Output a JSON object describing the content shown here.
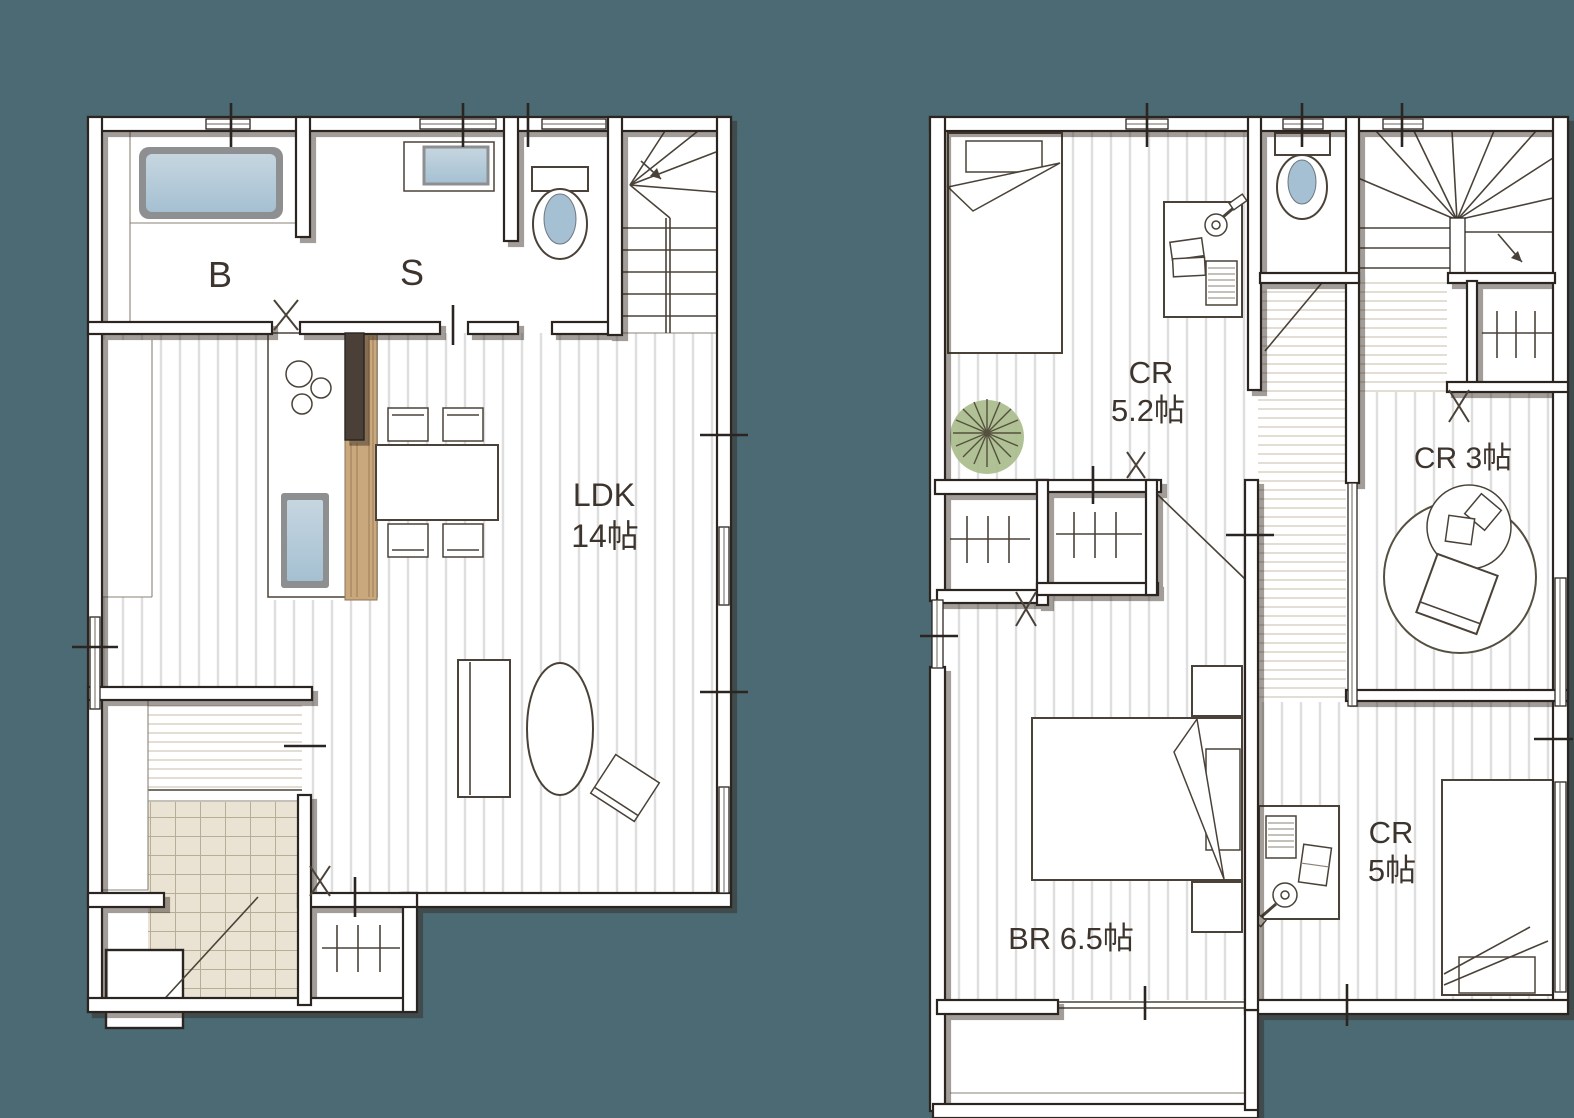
{
  "colors": {
    "background": "#4c6a73",
    "ink": "#2b2522",
    "text": "#3d352d",
    "water_light": "#c6d6e0",
    "water": "#a5c0d2",
    "fixture_rim": "#8d8f91",
    "wood": "#c9a87d",
    "wood_line": "#a5835c",
    "tile": "#eae3d3",
    "tile_line": "#b7ae97",
    "plant": "#a9bd8c",
    "floor_stripe": "#dedede",
    "plank": "#d8d2c4"
  },
  "floor1": {
    "bath_label": "B",
    "sanitary_label": "S",
    "ldk_label": "LDK",
    "ldk_size": "14帖"
  },
  "floor2": {
    "cr52_label": "CR",
    "cr52_size": "5.2帖",
    "cr3_label": "CR 3帖",
    "br_label": "BR 6.5帖",
    "cr5_label": "CR",
    "cr5_size": "5帖"
  }
}
